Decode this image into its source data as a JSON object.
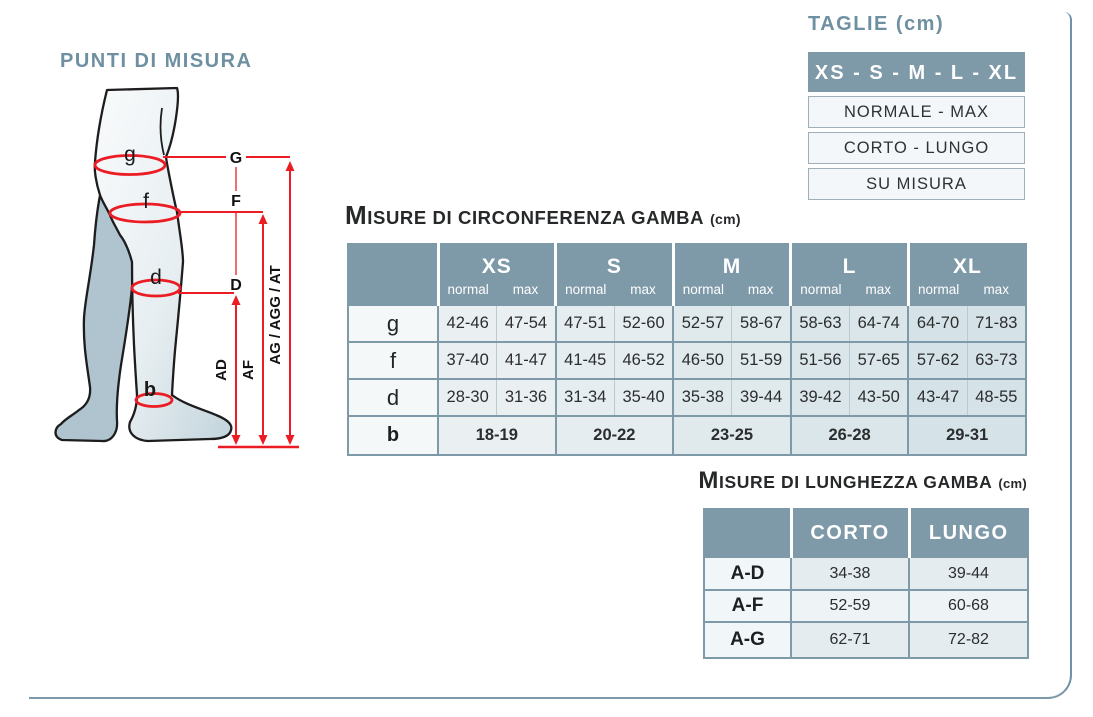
{
  "figure": {
    "title": "PUNTI DI MISURA",
    "points": {
      "g": "g",
      "f": "f",
      "d": "d",
      "b": "b"
    },
    "lines": {
      "G": "G",
      "F": "F",
      "D": "D"
    },
    "lengths": {
      "ad": "AD",
      "af": "AF",
      "ag": "AG / AGG / AT"
    }
  },
  "taglie": {
    "title": "TAGLIE (cm)",
    "header": "XS - S - M - L - XL",
    "rows": [
      "NORMALE - MAX",
      "CORTO - LUNGO",
      "SU MISURA"
    ]
  },
  "circ": {
    "title": {
      "lead": "M",
      "rest": "ISURE DI CIRCONFERENZA GAMBA",
      "unit": "(cm)"
    },
    "sizes": [
      "XS",
      "S",
      "M",
      "L",
      "XL"
    ],
    "sub": [
      "normal",
      "max"
    ],
    "rows": [
      {
        "label": "g",
        "values": [
          "42-46",
          "47-54",
          "47-51",
          "52-60",
          "52-57",
          "58-67",
          "58-63",
          "64-74",
          "64-70",
          "71-83"
        ]
      },
      {
        "label": "f",
        "values": [
          "37-40",
          "41-47",
          "41-45",
          "46-52",
          "46-50",
          "51-59",
          "51-56",
          "57-65",
          "57-62",
          "63-73"
        ]
      },
      {
        "label": "d",
        "values": [
          "28-30",
          "31-36",
          "31-34",
          "35-40",
          "35-38",
          "39-44",
          "39-42",
          "43-50",
          "43-47",
          "48-55"
        ]
      }
    ],
    "row_b": {
      "label": "b",
      "values": [
        "18-19",
        "20-22",
        "23-25",
        "26-28",
        "29-31"
      ]
    }
  },
  "lengths": {
    "title": {
      "lead": "M",
      "rest": "ISURE DI LUNGHEZZA GAMBA",
      "unit": "(cm)"
    },
    "columns": [
      "CORTO",
      "LUNGO"
    ],
    "rows": [
      {
        "label": "A-D",
        "values": [
          "34-38",
          "39-44"
        ]
      },
      {
        "label": "A-F",
        "values": [
          "52-59",
          "60-68"
        ]
      },
      {
        "label": "A-G",
        "values": [
          "62-71",
          "72-82"
        ]
      }
    ]
  },
  "colors": {
    "header_bluegray": "#7e99a8",
    "title_blue": "#6e90a1",
    "measure_red": "#ec1c24",
    "cell_light": "#e5edf0",
    "label_col": "#f4f8f9",
    "page_border": "#6f92a8",
    "leg_back": "#afc4cf",
    "leg_front": "#e9f0f2"
  }
}
